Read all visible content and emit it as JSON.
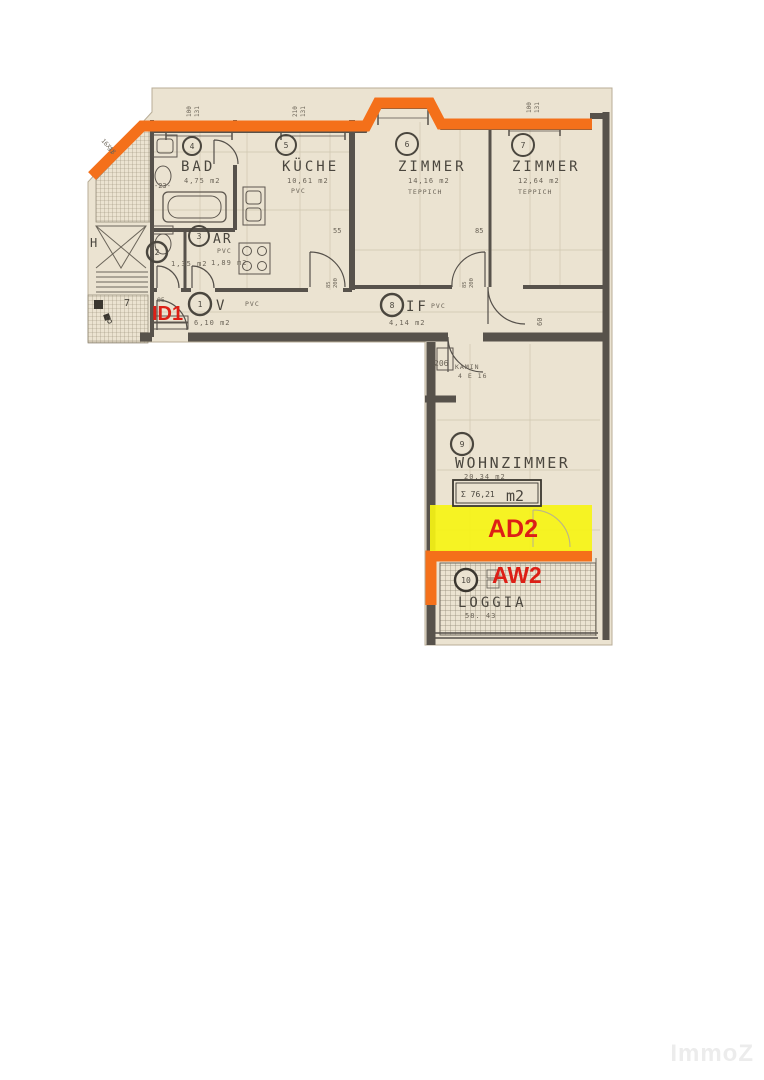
{
  "watermark": "ImmoZ",
  "colors": {
    "wall_highlight_orange": "#f4701a",
    "area_highlight_yellow": "#f6f414",
    "annotation_red": "#dd1f16",
    "paper": "#ebe3d1",
    "ink": "#4a463e"
  },
  "annotations": {
    "id1": "ID1",
    "ad2": "AD2",
    "aw2": "AW2"
  },
  "total": {
    "sum": "Σ 76,21",
    "unit": "m2"
  },
  "rooms": [
    {
      "no": "4",
      "name": "BAD",
      "area": "4,75 m2",
      "floor": ""
    },
    {
      "no": "5",
      "name": "KÜCHE",
      "area": "10,61 m2",
      "floor": "PVC"
    },
    {
      "no": "6",
      "name": "ZIMMER",
      "area": "14,16 m2",
      "floor": "TEPPICH"
    },
    {
      "no": "7",
      "name": "ZIMMER",
      "area": "12,64 m2",
      "floor": "TEPPICH"
    },
    {
      "no": "3",
      "name": "AR",
      "area": "1,89 m2",
      "floor": "PVC"
    },
    {
      "no": "2",
      "name": "",
      "area": "1,35 m2",
      "floor": ""
    },
    {
      "no": "1",
      "name": "V",
      "area": "6,10 m2",
      "floor": "PVC"
    },
    {
      "no": "8",
      "name": "IF",
      "area": "4,14 m2",
      "floor": "PVC"
    },
    {
      "no": "9",
      "name": "WOHNZIMMER",
      "area": "20,34 m2",
      "floor": ""
    },
    {
      "no": "10",
      "name": "LOGGIA",
      "area": "58. 43",
      "floor": ""
    }
  ],
  "texts": {
    "kamin_1": "KAMIN",
    "kamin_2": "4 E 16",
    "stair_h": "H",
    "stair_note_1": "16X18",
    "stair_note_2": "31",
    "mark_7": "7",
    "mark_8": "8"
  },
  "dims": {
    "w1a": "100",
    "w1b": "131",
    "w2a": "210",
    "w2b": "131",
    "w3a": "100",
    "w3b": "131",
    "d55": "55",
    "d85": "85",
    "d23": "-23-",
    "d206": "206",
    "d60": "60",
    "d85_entry": "85",
    "door_a_w": "85",
    "door_a_h": "200",
    "door_b_w": "85",
    "door_b_h": "200"
  }
}
